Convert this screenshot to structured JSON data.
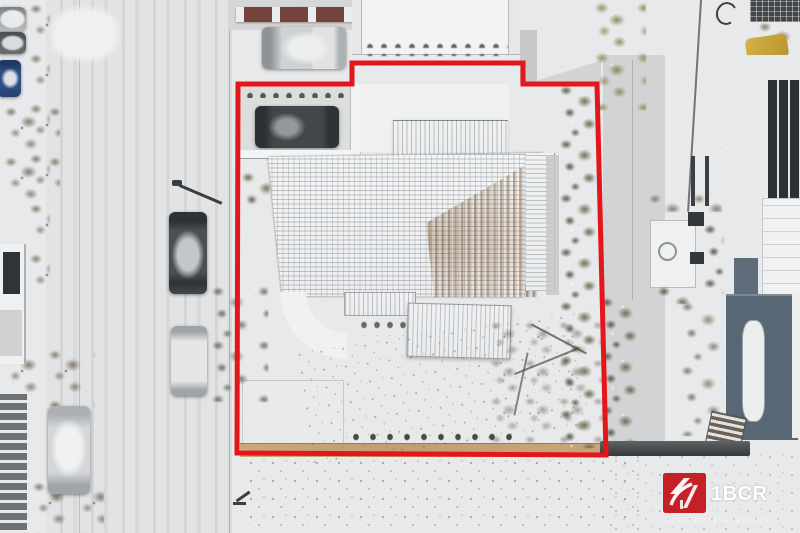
{
  "image": {
    "width": 800,
    "height": 533,
    "kind": "winter aerial drone photo of a house plot for sale"
  },
  "branding": {
    "company": "1BCR",
    "tagline_words": [
      "REAL",
      "ESTATE",
      "GROUP"
    ],
    "logo_bg": "#c42127",
    "logo_fg": "#ffffff"
  },
  "boundary": {
    "color": "#e3171b",
    "stroke_px": 5,
    "points": "238,84 352,84 352,63 523,63 523,84 597,84 606,455 237,453"
  },
  "palette": {
    "snow": "#e8e9ea",
    "road": "#e1e2e3",
    "pavement": "#d8d9da",
    "roof_white": "#f1f2f3",
    "roof_worn_brown": "#8a6544",
    "hedge_olive": "#5c5f4a",
    "bare_tree_brown": "#6f6256",
    "tan_path": "#c4a277",
    "dark_car": "#3f4245",
    "neighbor_roof_blue": "#5a6a76",
    "fence_maroon": "#74443c"
  }
}
